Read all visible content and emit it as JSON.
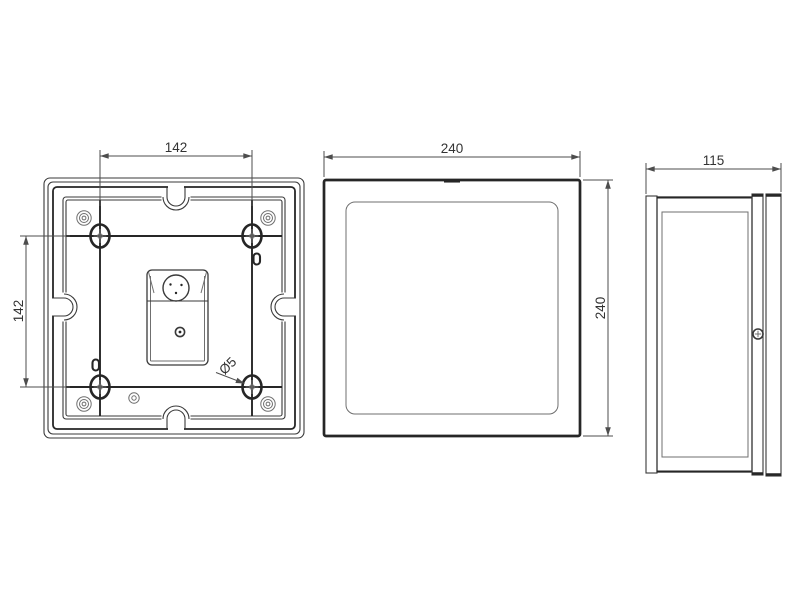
{
  "drawing": {
    "back_view": {
      "dim_horizontal": "142",
      "dim_vertical": "142",
      "hole_label": "Ø5"
    },
    "front_view": {
      "dim_width": "240",
      "dim_height": "240"
    },
    "side_view": {
      "dim_depth": "115"
    },
    "colors": {
      "background": "#ffffff",
      "line": "#3a3a3a",
      "line_dark": "#262626",
      "dim": "#4d4d4d",
      "text": "#333333"
    }
  }
}
